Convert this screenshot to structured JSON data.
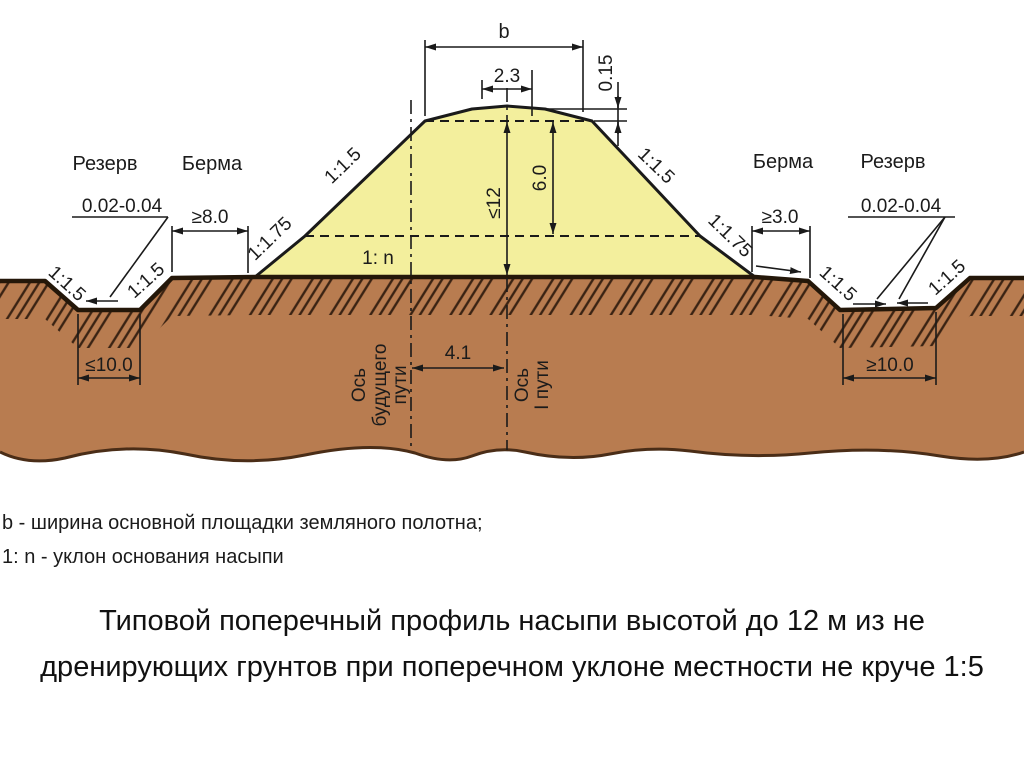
{
  "colors": {
    "embankment_fill": "#f3ef9d",
    "ground_fill": "#b87c50",
    "outline": "#1a1a1a",
    "ground_line": "#241709",
    "ground_edge": "#4a2d17",
    "hatch_line": "#3a2313"
  },
  "diagram": {
    "labels": {
      "reserve_left": "Резерв",
      "berm_left": "Берма",
      "berm_right": "Берма",
      "reserve_right": "Резерв",
      "base_slope": "1: n"
    },
    "dimensions": {
      "crest_width": "b",
      "top_width": "2.3",
      "camber": "0.15",
      "height_max": "≤12",
      "height_upper": "6.0",
      "track_spacing": "4.1",
      "berm_left_width": "≥8.0",
      "berm_right_width": "≥3.0",
      "reserve_left_bottom": "≤10.0",
      "reserve_right_bottom": "≥10.0",
      "reserve_left_grade": "0.02-0.04",
      "reserve_right_grade": "0.02-0.04"
    },
    "slopes": {
      "left_upper": "1:1.5",
      "left_lower": "1:1.75",
      "right_upper": "1:1.5",
      "right_lower": "1:1.75",
      "ditch_left_outer": "1:1.5",
      "ditch_left_inner": "1:1.5",
      "ditch_right_inner": "1:1.5",
      "ditch_right_outer": "1:1.5"
    },
    "axes": {
      "future_line1": "Ось",
      "future_line2": "будущего",
      "future_line3": "пути",
      "track1_line1": "Ось",
      "track1_line2": "I пути"
    }
  },
  "legend": {
    "line1": "b - ширина основной площадки земляного полотна;",
    "line2": "1: n - уклон основания насыпи"
  },
  "caption": "Типовой поперечный профиль насыпи высотой до 12 м из не дренирующих грунтов при поперечном уклоне местности не круче 1:5"
}
